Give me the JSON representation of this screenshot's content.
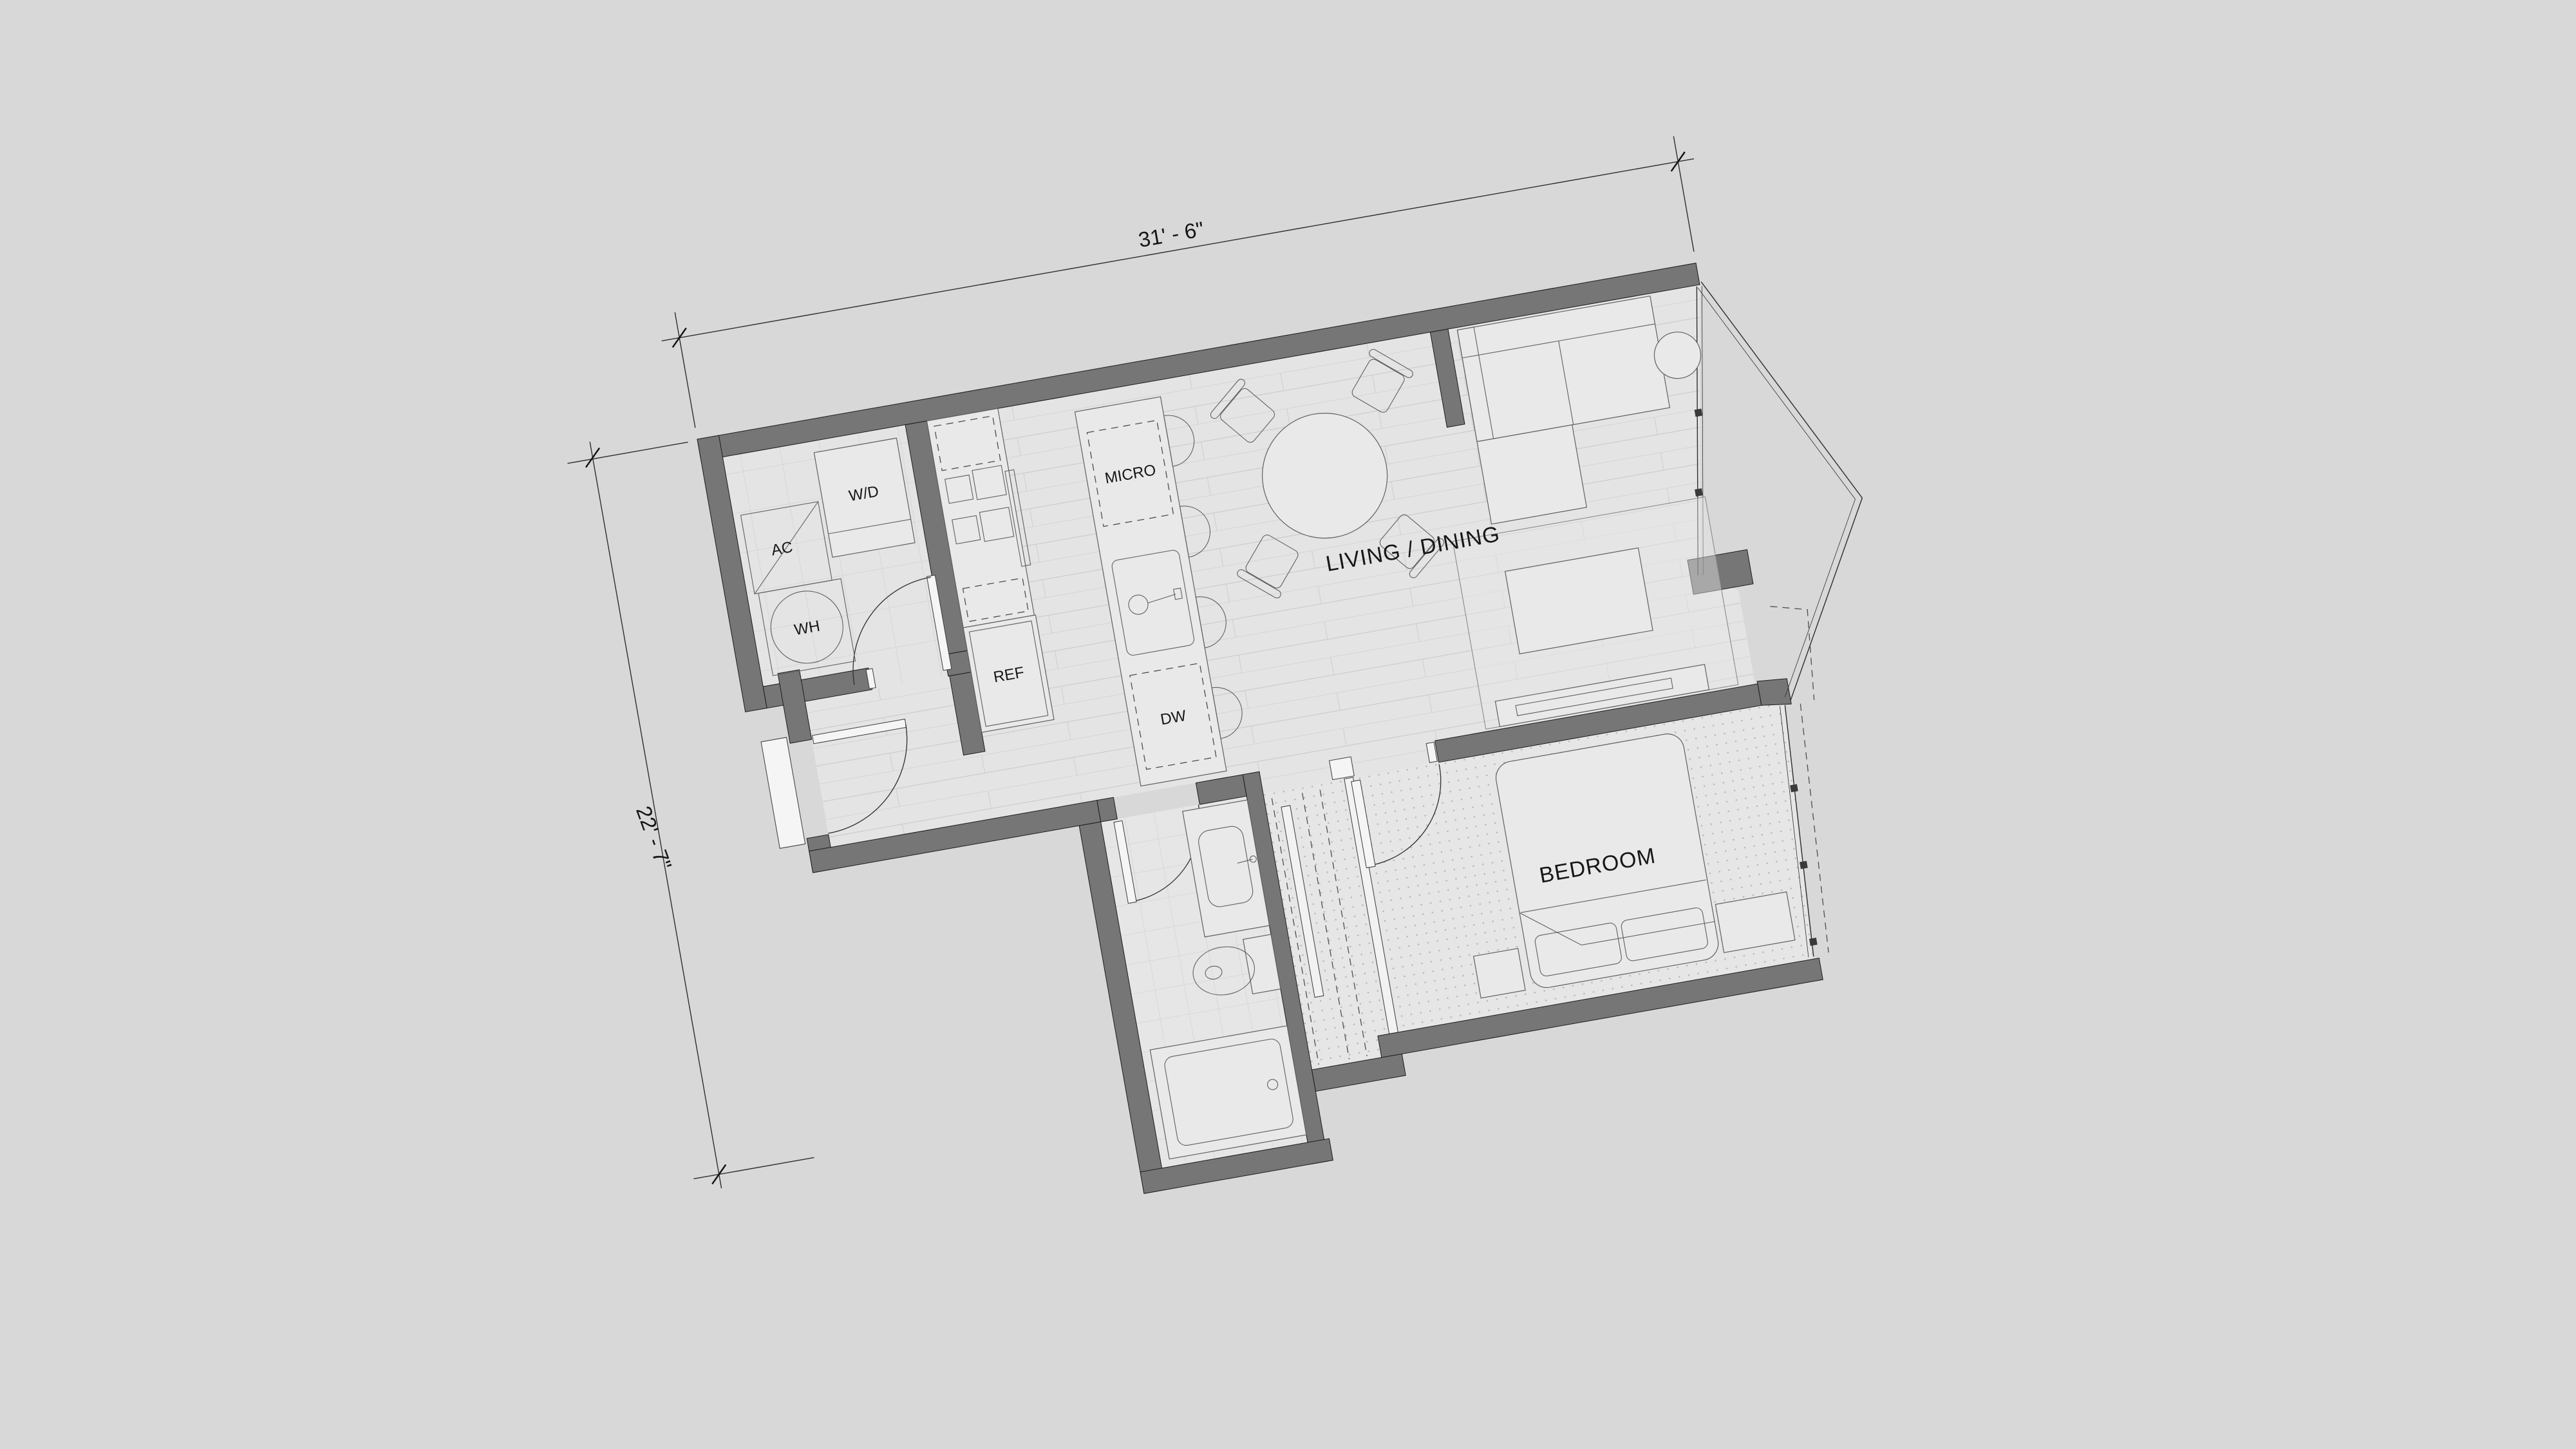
{
  "plan": {
    "rooms": {
      "living_dining": "LIVING / DINING",
      "bedroom": "BEDROOM"
    },
    "appliances": {
      "washer_dryer": "W/D",
      "ac": "AC",
      "water_heater": "WH",
      "refrigerator": "REF",
      "microwave": "MICRO",
      "dishwasher": "DW"
    },
    "dimensions": {
      "overall_width": "31' - 6\"",
      "overall_depth": "22' - 7\""
    },
    "colors": {
      "background": "#d8d8d8",
      "wall_fill": "#767676",
      "floor_fill": "#e4e4e4",
      "line": "#2d2d2d"
    },
    "rotation_degrees": -10
  }
}
